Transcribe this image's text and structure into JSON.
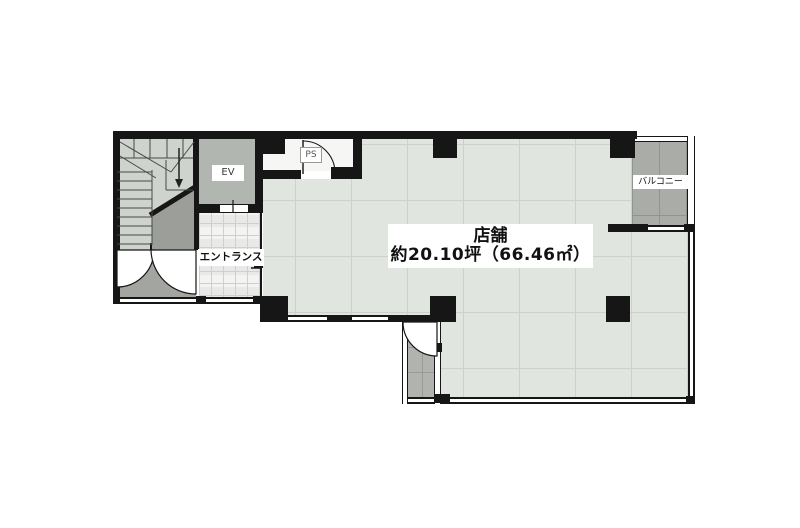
{
  "plan": {
    "title_none_visible": "",
    "rooms": {
      "store": {
        "name": "店舗",
        "area": "約20.10坪（66.46㎡）"
      },
      "entrance": {
        "label": "エントランス"
      },
      "elevator": {
        "label": "EV"
      },
      "pipe_space": {
        "label": "PS"
      },
      "balcony": {
        "label": "バルコニー"
      }
    },
    "icons": {
      "stairs_direction": "down-arrow"
    },
    "colors": {
      "wall": "#161616",
      "shop_floor": "#e1e5df",
      "shop_floor_grid": "#ccd1ca",
      "stairs_floor": "#cfd3cd",
      "elevator_room": "#b2b6b1",
      "vestibule": "#a2a5a0",
      "entrance_tile": "#f3f3f1",
      "balcony_floor": "#a9aca7",
      "background": "#ffffff"
    }
  }
}
